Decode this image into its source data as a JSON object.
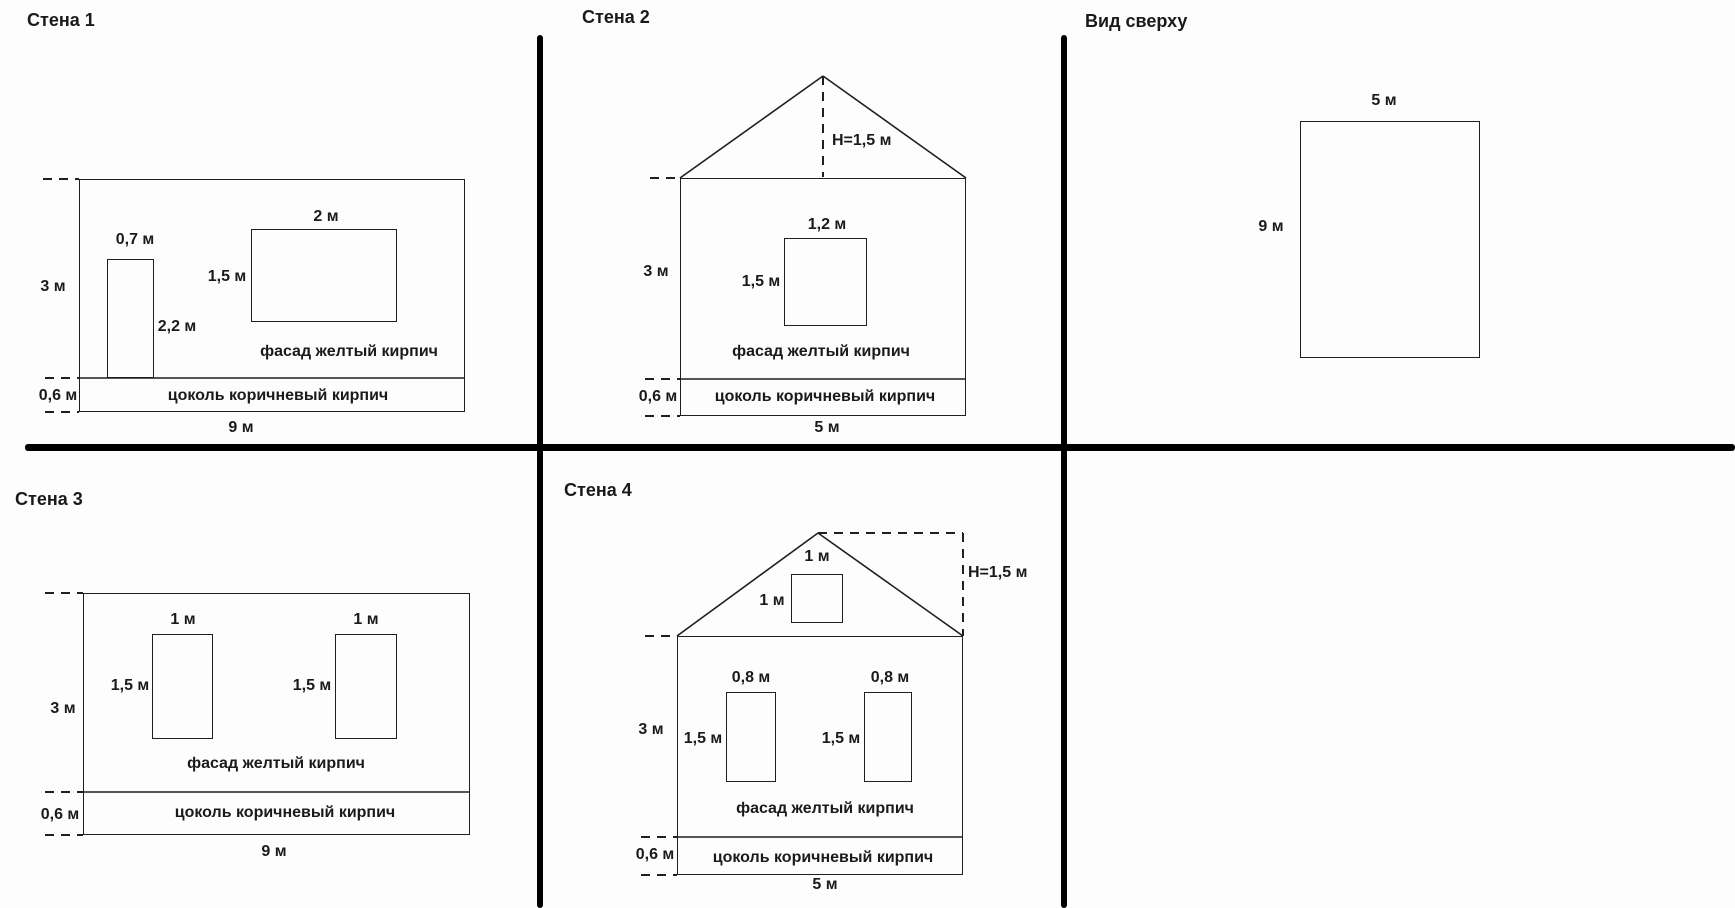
{
  "colors": {
    "background": "#fdfdfd",
    "line": "#1f1f1f",
    "text": "#1a1a1a",
    "divider": "#000000"
  },
  "panels": {
    "wall1": {
      "title": "Стена 1",
      "facade_label": "фасад желтый кирпич",
      "plinth_label": "цоколь коричневый кирпич",
      "dims": {
        "door_width": "0,7 м",
        "door_height": "2,2 м",
        "window_width": "2 м",
        "window_height": "1,5 м",
        "wall_height": "3 м",
        "plinth_height": "0,6 м",
        "wall_width": "9 м"
      }
    },
    "wall2": {
      "title": "Стена 2",
      "facade_label": "фасад желтый кирпич",
      "plinth_label": "цоколь коричневый кирпич",
      "dims": {
        "roof_height": "H=1,5 м",
        "window_width": "1,2 м",
        "window_height": "1,5 м",
        "wall_height": "3 м",
        "plinth_height": "0,6 м",
        "wall_width": "5 м"
      }
    },
    "top_view": {
      "title": "Вид сверху",
      "dims": {
        "width": "5 м",
        "depth": "9 м"
      }
    },
    "wall3": {
      "title": "Стена 3",
      "facade_label": "фасад желтый кирпич",
      "plinth_label": "цоколь коричневый кирпич",
      "dims": {
        "window1_width": "1 м",
        "window1_height": "1,5 м",
        "window2_width": "1 м",
        "window2_height": "1,5 м",
        "wall_height": "3 м",
        "plinth_height": "0,6 м",
        "wall_width": "9 м"
      }
    },
    "wall4": {
      "title": "Стена 4",
      "facade_label": "фасад желтый кирпич",
      "plinth_label": "цоколь коричневый кирпич",
      "dims": {
        "roof_height": "H=1,5 м",
        "attic_window_width": "1 м",
        "attic_window_height": "1 м",
        "window1_width": "0,8 м",
        "window1_height": "1,5 м",
        "window2_width": "0,8 м",
        "window2_height": "1,5 м",
        "wall_height": "3 м",
        "plinth_height": "0,6 м",
        "wall_width": "5 м"
      }
    }
  }
}
